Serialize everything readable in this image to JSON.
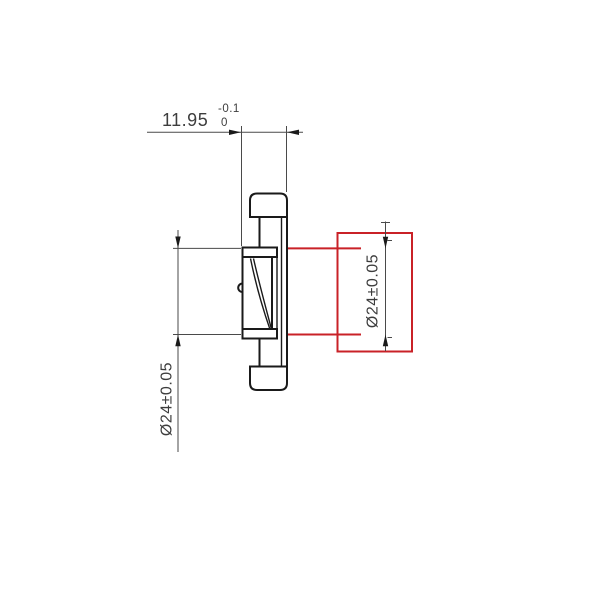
{
  "drawing": {
    "top_dimension": {
      "value": "11.95",
      "tolerance_upper": "-0.1",
      "tolerance_lower": "0"
    },
    "left_dimension": {
      "label": "Ø24±0.05"
    },
    "highlighted_dimension": {
      "label": "Ø24±0.05"
    }
  },
  "colors": {
    "background": "#ffffff",
    "part_outline": "#1a1a1a",
    "dimension_line": "#4a4a4a",
    "text": "#3d3d3d",
    "highlight_red": "#c92127"
  }
}
